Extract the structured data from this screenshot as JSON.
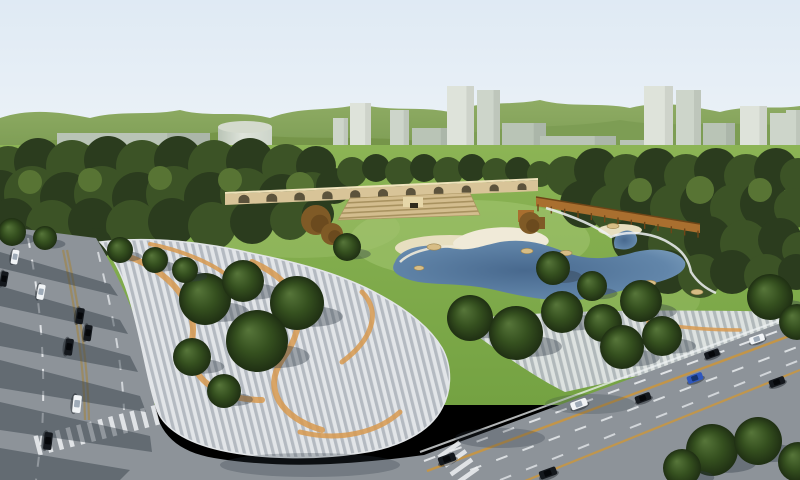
{
  "scene": {
    "kind": "architectural-aerial-render",
    "subject": "urban park masterplan with striped plaza, lake, arched wall, pergola, roads with traffic, background city towers and green hills"
  },
  "palette": {
    "sky_top": "#dfeaf4",
    "sky_bottom": "#eef3f8",
    "hill_far_top": "#8fac64",
    "hill_far_bottom": "#6f9148",
    "hill_near_left": "#769549",
    "hill_near_right": "#7d9d54",
    "building_light": "#dee3da",
    "building_mid": "#cdd5ca",
    "building_deep": "#b9c4b6",
    "cylinder_top": "#d4dacd",
    "dark_tower": "#3d4936",
    "forest_dark": "#2b3c1e",
    "forest_mid": "#3c5326",
    "forest_light": "#587434",
    "lawn_top": "#8cb455",
    "lawn_bottom": "#74a242",
    "lawn_glow": "#a6c773",
    "pond_deep": "#48698e",
    "pond_mid": "#6286aa",
    "pond_light": "#86a7c4",
    "sand": "#e7dfc0",
    "sand_bright": "#f0ead8",
    "rock": "#d7bd85",
    "wall_tan": "#d8c498",
    "wall_coping": "#efe3bc",
    "wall_arch": "#46402c",
    "terrace": "#d3bd8e",
    "terrace_dark": "#a8925f",
    "pavilion": "#e6d6a8",
    "pergola": "#a96f2f",
    "pergola_dark": "#6e4517",
    "rust_tree": "#7f5a26",
    "rust_tree_dark": "#5e4019",
    "plaza_base": "#cbd0d5",
    "stripe_light": "#e2e5e8",
    "stripe_dark": "#b4bac1",
    "plaza_orange": "#d89a50",
    "road": "#8d9399",
    "marking": "#eef1f3",
    "marking_orange": "#c9963f",
    "median_tan": "#9b8a5e",
    "shadow_road": "#2f3a44",
    "tree_hi": "#57763a",
    "tree_mid": "#35501f",
    "tree_edge": "#1f2f13",
    "car_white": "#f1f4f6",
    "car_black": "#14181d",
    "car_blue": "#2e57bd",
    "cab_white": "#9fabb8",
    "cab_black": "#05070a",
    "cab_blue": "#16346e"
  },
  "city_buildings": [
    [
      57,
      133,
      153,
      45,
      2
    ],
    [
      333,
      118,
      15,
      60,
      1
    ],
    [
      350,
      103,
      21,
      76,
      0
    ],
    [
      390,
      110,
      19,
      70,
      1
    ],
    [
      412,
      128,
      40,
      47,
      2
    ],
    [
      447,
      86,
      27,
      88,
      0
    ],
    [
      477,
      90,
      23,
      83,
      1
    ],
    [
      502,
      123,
      44,
      50,
      2
    ],
    [
      540,
      136,
      76,
      28,
      2
    ],
    [
      620,
      140,
      40,
      24,
      2
    ],
    [
      644,
      86,
      29,
      92,
      0
    ],
    [
      676,
      90,
      25,
      88,
      1
    ],
    [
      703,
      123,
      32,
      57,
      2
    ],
    [
      740,
      106,
      27,
      82,
      0
    ],
    [
      770,
      113,
      29,
      78,
      1
    ],
    [
      700,
      155,
      62,
      28,
      2
    ],
    [
      786,
      110,
      14,
      82,
      1
    ]
  ],
  "forest_puffs": [
    [
      8,
      168,
      22,
      1
    ],
    [
      38,
      162,
      24,
      0
    ],
    [
      72,
      166,
      26,
      1
    ],
    [
      108,
      160,
      24,
      0
    ],
    [
      142,
      166,
      26,
      1
    ],
    [
      178,
      160,
      24,
      0
    ],
    [
      214,
      166,
      26,
      1
    ],
    [
      250,
      162,
      24,
      0
    ],
    [
      286,
      168,
      24,
      1
    ],
    [
      316,
      166,
      20,
      0
    ],
    [
      0,
      196,
      26,
      0
    ],
    [
      32,
      194,
      28,
      1
    ],
    [
      66,
      198,
      26,
      0
    ],
    [
      102,
      194,
      28,
      1
    ],
    [
      138,
      198,
      26,
      0
    ],
    [
      174,
      194,
      28,
      1
    ],
    [
      210,
      198,
      26,
      0
    ],
    [
      246,
      194,
      26,
      1
    ],
    [
      282,
      198,
      24,
      0
    ],
    [
      312,
      194,
      22,
      1
    ],
    [
      334,
      186,
      18,
      0
    ],
    [
      12,
      222,
      24,
      0
    ],
    [
      52,
      226,
      26,
      1
    ],
    [
      92,
      222,
      24,
      0
    ],
    [
      132,
      226,
      26,
      1
    ],
    [
      172,
      222,
      24,
      0
    ],
    [
      212,
      226,
      24,
      1
    ],
    [
      252,
      222,
      22,
      0
    ],
    [
      290,
      220,
      20,
      1
    ],
    [
      318,
      214,
      16,
      0
    ],
    [
      18,
      244,
      20,
      0
    ],
    [
      58,
      246,
      18,
      1
    ],
    [
      96,
      244,
      16,
      0
    ],
    [
      30,
      182,
      12,
      2
    ],
    [
      90,
      180,
      12,
      2
    ],
    [
      160,
      178,
      12,
      2
    ],
    [
      230,
      180,
      12,
      2
    ],
    [
      300,
      186,
      14,
      2
    ],
    [
      352,
      172,
      15,
      1
    ],
    [
      376,
      168,
      14,
      0
    ],
    [
      400,
      172,
      15,
      1
    ],
    [
      424,
      168,
      14,
      0
    ],
    [
      448,
      172,
      15,
      1
    ],
    [
      472,
      168,
      14,
      0
    ],
    [
      496,
      172,
      14,
      1
    ],
    [
      518,
      170,
      13,
      0
    ],
    [
      540,
      174,
      13,
      1
    ],
    [
      566,
      176,
      20,
      1
    ],
    [
      596,
      170,
      22,
      0
    ],
    [
      626,
      176,
      22,
      1
    ],
    [
      656,
      170,
      22,
      0
    ],
    [
      686,
      176,
      22,
      1
    ],
    [
      716,
      170,
      22,
      0
    ],
    [
      746,
      176,
      22,
      1
    ],
    [
      776,
      170,
      22,
      0
    ],
    [
      798,
      176,
      18,
      1
    ],
    [
      584,
      204,
      24,
      0
    ],
    [
      614,
      208,
      24,
      1
    ],
    [
      644,
      204,
      24,
      0
    ],
    [
      674,
      208,
      24,
      1
    ],
    [
      704,
      204,
      24,
      0
    ],
    [
      734,
      208,
      24,
      1
    ],
    [
      764,
      204,
      24,
      0
    ],
    [
      794,
      208,
      20,
      1
    ],
    [
      640,
      190,
      12,
      2
    ],
    [
      700,
      190,
      14,
      2
    ],
    [
      760,
      190,
      12,
      2
    ],
    [
      636,
      240,
      24,
      0
    ],
    [
      672,
      244,
      24,
      1
    ],
    [
      708,
      240,
      24,
      0
    ],
    [
      744,
      244,
      24,
      1
    ],
    [
      780,
      240,
      22,
      0
    ],
    [
      800,
      250,
      18,
      1
    ],
    [
      668,
      272,
      22,
      0
    ],
    [
      700,
      276,
      22,
      1
    ],
    [
      732,
      272,
      22,
      0
    ],
    [
      766,
      276,
      22,
      1
    ],
    [
      796,
      272,
      18,
      0
    ]
  ],
  "park_trees": [
    [
      205,
      299,
      26
    ],
    [
      243,
      281,
      21
    ],
    [
      297,
      303,
      27
    ],
    [
      257,
      341,
      31
    ],
    [
      192,
      357,
      19
    ],
    [
      224,
      391,
      17
    ],
    [
      347,
      247,
      14
    ],
    [
      470,
      318,
      23
    ],
    [
      516,
      333,
      27
    ],
    [
      562,
      312,
      21
    ],
    [
      603,
      323,
      19
    ],
    [
      553,
      268,
      17
    ],
    [
      592,
      286,
      15
    ],
    [
      641,
      301,
      21
    ],
    [
      622,
      347,
      22
    ],
    [
      662,
      336,
      20
    ],
    [
      770,
      297,
      23
    ],
    [
      797,
      322,
      18
    ],
    [
      712,
      450,
      26
    ],
    [
      758,
      441,
      24
    ],
    [
      682,
      468,
      19
    ],
    [
      798,
      462,
      20
    ],
    [
      120,
      250,
      13
    ],
    [
      155,
      260,
      13
    ],
    [
      185,
      270,
      13
    ],
    [
      12,
      232,
      14
    ],
    [
      45,
      238,
      12
    ]
  ],
  "accent_trees": [
    [
      316,
      220,
      15
    ],
    [
      332,
      234,
      11
    ],
    [
      530,
      223,
      11
    ]
  ],
  "rocks": [
    [
      434,
      247,
      7
    ],
    [
      527,
      251,
      6
    ],
    [
      566,
      253,
      6
    ],
    [
      613,
      226,
      6
    ],
    [
      650,
      283,
      6
    ],
    [
      697,
      292,
      6
    ],
    [
      419,
      268,
      5
    ]
  ],
  "cars": {
    "left_road": [
      [
        15,
        257,
        "w",
        100,
        0.9
      ],
      [
        4,
        279,
        "k",
        100,
        0.95
      ],
      [
        41,
        292,
        "w",
        100,
        0.95
      ],
      [
        80,
        316,
        "k",
        99,
        1.0
      ],
      [
        88,
        333,
        "k",
        98,
        1.0
      ],
      [
        69,
        347,
        "k",
        98,
        1.05
      ],
      [
        77,
        404,
        "w",
        96,
        1.1
      ],
      [
        48,
        441,
        "k",
        96,
        1.1
      ]
    ],
    "right_road": [
      [
        447,
        459,
        "k",
        -20,
        1.1
      ],
      [
        548,
        473,
        "k",
        -20,
        1.1
      ],
      [
        579,
        404,
        "w",
        -20,
        1.05
      ],
      [
        643,
        398,
        "k",
        -20,
        1.0
      ],
      [
        695,
        378,
        "b",
        -20,
        1.0
      ],
      [
        712,
        354,
        "k",
        -20,
        0.95
      ],
      [
        757,
        339,
        "w",
        -19,
        0.95
      ],
      [
        777,
        382,
        "k",
        -20,
        1.0
      ]
    ]
  },
  "arch_wall": {
    "arch_count": 11
  },
  "pergola": {
    "post_count": 13
  }
}
